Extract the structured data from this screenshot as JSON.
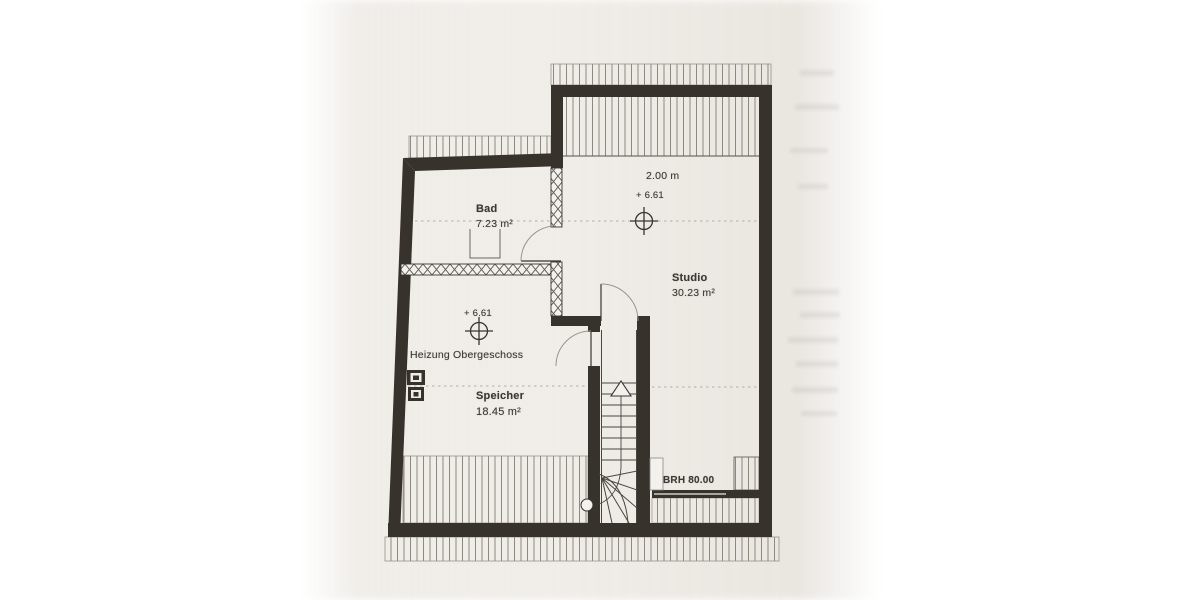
{
  "plan": {
    "rooms": {
      "bad": {
        "name": "Bad",
        "area": "7.23 m²"
      },
      "studio": {
        "name": "Studio",
        "area": "30.23 m²"
      },
      "speicher": {
        "name": "Speicher",
        "area": "18.45 m²"
      }
    },
    "annotations": {
      "heizung": "Heizung Obergeschoss",
      "clearance_line": "2.00 m",
      "elevation_studio": "+ 6.61",
      "elevation_speicher": "+ 6.61",
      "sill_height": "BRH 80.00"
    },
    "colors": {
      "ink": "#3a3430",
      "wall": "#38322c",
      "hatch_line": "#8d8880",
      "paper_tint": "#ebe7e1"
    }
  }
}
